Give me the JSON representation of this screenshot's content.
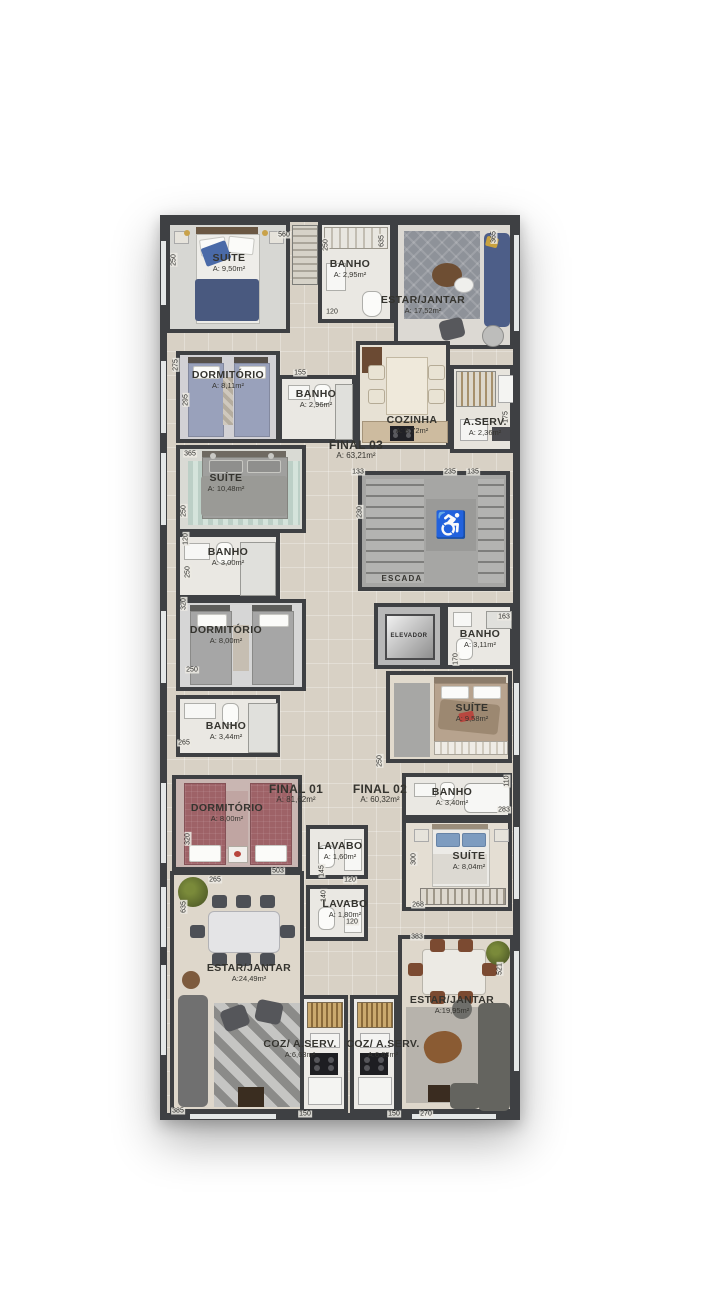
{
  "plan": {
    "palette": {
      "wall": "#3e4043",
      "corridor_floor": "#d8d1c5",
      "accent_blue": "#4c5f8e",
      "accent_teal": "#a9bdb4",
      "accent_taupe": "#b7a38e",
      "accent_red": "#9e6267"
    },
    "units": [
      {
        "id": "final01",
        "label": "FINAL 01",
        "area": "A: 81,62m²"
      },
      {
        "id": "final02",
        "label": "FINAL 02",
        "area": "A: 60,32m²"
      },
      {
        "id": "final03",
        "label": "FINAL 03",
        "area": "A: 63,21m²"
      }
    ],
    "rooms": {
      "suite1": {
        "name": "SUÍTE",
        "area": "A: 9,50m²"
      },
      "banho1": {
        "name": "BANHO",
        "area": "A: 2,95m²"
      },
      "estar1": {
        "name": "ESTAR/JANTAR",
        "area": "A: 17,52m²"
      },
      "dorm1": {
        "name": "DORMITÓRIO",
        "area": "A: 8,11m²"
      },
      "banho2": {
        "name": "BANHO",
        "area": "A: 2,96m²"
      },
      "cozinha": {
        "name": "COZINHA",
        "area": "A: 8,72m²"
      },
      "aserv": {
        "name": "A.SERV.",
        "area": "A: 2,36m²"
      },
      "final03": {
        "name": "FINAL 03",
        "area": "A: 63,21m²"
      },
      "suite2": {
        "name": "SUÍTE",
        "area": "A: 10,48m²"
      },
      "banho3": {
        "name": "BANHO",
        "area": "A: 3,00m²"
      },
      "dorm2": {
        "name": "DORMITÓRIO",
        "area": "A: 8,00m²"
      },
      "escada": {
        "name": "ESCADA"
      },
      "elevador": {
        "name": "ELEVADOR"
      },
      "banho4": {
        "name": "BANHO",
        "area": "A: 3,11m²"
      },
      "suite3": {
        "name": "SUÍTE",
        "area": "A: 9,58m²"
      },
      "banho5": {
        "name": "BANHO",
        "area": "A: 3,44m²"
      },
      "dorm3": {
        "name": "DORMITÓRIO",
        "area": "A: 8,00m²"
      },
      "final01": {
        "name": "FINAL 01",
        "area": "A: 81,62m²"
      },
      "final02": {
        "name": "FINAL 02",
        "area": "A: 60,32m²"
      },
      "banho6": {
        "name": "BANHO",
        "area": "A: 3,40m²"
      },
      "suite4": {
        "name": "SUÍTE",
        "area": "A: 8,04m²"
      },
      "lavabo1": {
        "name": "LAVABO",
        "area": "A: 1,60m²"
      },
      "lavabo2": {
        "name": "LAVABO",
        "area": "A: 1,80m²"
      },
      "estar2": {
        "name": "ESTAR/JANTAR",
        "area": "A:24,49m²"
      },
      "coz1": {
        "name": "COZ/ A.SERV.",
        "area": "A:6,63m²"
      },
      "coz2": {
        "name": "COZ/ A.SERV.",
        "area": "A:6,63m²"
      },
      "estar3": {
        "name": "ESTAR/JANTAR",
        "area": "A:19,95m²"
      }
    },
    "icons": {
      "wheelchair": "♿"
    },
    "dimensions": [
      {
        "t": "250",
        "x": 14,
        "y": 45,
        "r": 90
      },
      {
        "t": "560",
        "x": 124,
        "y": 20,
        "r": 0
      },
      {
        "t": "250",
        "x": 166,
        "y": 30,
        "r": 90
      },
      {
        "t": "365",
        "x": 334,
        "y": 22,
        "r": 90
      },
      {
        "t": "635",
        "x": 222,
        "y": 26,
        "r": 90
      },
      {
        "t": "120",
        "x": 172,
        "y": 97,
        "r": 0
      },
      {
        "t": "155",
        "x": 140,
        "y": 158,
        "r": 0
      },
      {
        "t": "275",
        "x": 16,
        "y": 150,
        "r": 90
      },
      {
        "t": "295",
        "x": 26,
        "y": 185,
        "r": 90
      },
      {
        "t": "175",
        "x": 346,
        "y": 202,
        "r": 90
      },
      {
        "t": "133",
        "x": 198,
        "y": 257,
        "r": 0
      },
      {
        "t": "235",
        "x": 290,
        "y": 257,
        "r": 0
      },
      {
        "t": "135",
        "x": 313,
        "y": 257,
        "r": 0
      },
      {
        "t": "230",
        "x": 200,
        "y": 297,
        "r": 90
      },
      {
        "t": "365",
        "x": 30,
        "y": 239,
        "r": 0
      },
      {
        "t": "250",
        "x": 24,
        "y": 296,
        "r": 90
      },
      {
        "t": "120",
        "x": 26,
        "y": 324,
        "r": 90
      },
      {
        "t": "250",
        "x": 28,
        "y": 357,
        "r": 90
      },
      {
        "t": "320",
        "x": 24,
        "y": 389,
        "r": 90
      },
      {
        "t": "250",
        "x": 32,
        "y": 455,
        "r": 0
      },
      {
        "t": "265",
        "x": 24,
        "y": 528,
        "r": 0
      },
      {
        "t": "163",
        "x": 344,
        "y": 402,
        "r": 0
      },
      {
        "t": "170",
        "x": 296,
        "y": 444,
        "r": 90
      },
      {
        "t": "250",
        "x": 220,
        "y": 546,
        "r": 90
      },
      {
        "t": "110",
        "x": 347,
        "y": 566,
        "r": 90
      },
      {
        "t": "283",
        "x": 344,
        "y": 595,
        "r": 0
      },
      {
        "t": "300",
        "x": 254,
        "y": 644,
        "r": 90
      },
      {
        "t": "268",
        "x": 258,
        "y": 690,
        "r": 0
      },
      {
        "t": "320",
        "x": 28,
        "y": 624,
        "r": 90
      },
      {
        "t": "265",
        "x": 55,
        "y": 665,
        "r": 0
      },
      {
        "t": "503",
        "x": 118,
        "y": 656,
        "r": 0
      },
      {
        "t": "145",
        "x": 162,
        "y": 656,
        "r": 90
      },
      {
        "t": "120",
        "x": 190,
        "y": 665,
        "r": 0
      },
      {
        "t": "140",
        "x": 164,
        "y": 681,
        "r": 90
      },
      {
        "t": "120",
        "x": 192,
        "y": 707,
        "r": 0
      },
      {
        "t": "635",
        "x": 24,
        "y": 692,
        "r": 90
      },
      {
        "t": "383",
        "x": 257,
        "y": 722,
        "r": 0
      },
      {
        "t": "521",
        "x": 340,
        "y": 754,
        "r": 90
      },
      {
        "t": "385",
        "x": 18,
        "y": 896,
        "r": 0
      },
      {
        "t": "150",
        "x": 145,
        "y": 899,
        "r": 0
      },
      {
        "t": "150",
        "x": 234,
        "y": 899,
        "r": 0
      },
      {
        "t": "270",
        "x": 266,
        "y": 899,
        "r": 0
      }
    ]
  }
}
